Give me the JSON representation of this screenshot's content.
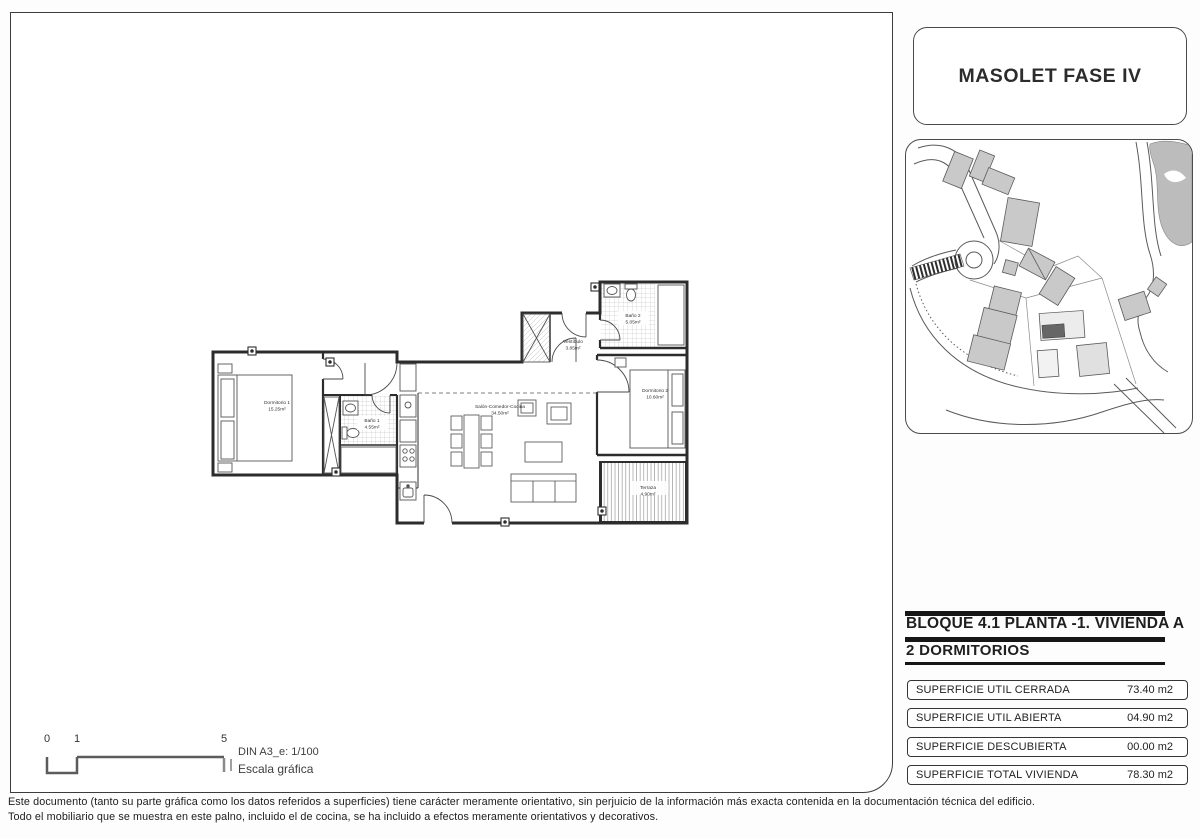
{
  "project": {
    "title": "MASOLET FASE IV"
  },
  "unit": {
    "block_title": "BLOQUE 4.1 PLANTA -1. VIVIENDA A",
    "bedrooms_title": "2 DORMITORIOS"
  },
  "surface_table": {
    "rows": [
      {
        "label": "SUPERFICIE UTIL CERRADA",
        "value": "73.40 m2"
      },
      {
        "label": "SUPERFICIE UTIL ABIERTA",
        "value": "04.90 m2"
      },
      {
        "label": "SUPERFICIE DESCUBIERTA",
        "value": "00.00 m2"
      },
      {
        "label": "SUPERFICIE TOTAL VIVIENDA",
        "value": "78.30 m2"
      }
    ]
  },
  "floor_plan": {
    "rooms": [
      {
        "name": "Dormitorio 1",
        "area": "15.25m²"
      },
      {
        "name": "Baño 1",
        "area": "4.55m²"
      },
      {
        "name": "Salón-Comedor-Cocina",
        "area": "34.50m²"
      },
      {
        "name": "Vestíbulo",
        "area": "3.85m²"
      },
      {
        "name": "Baño 2",
        "area": "5.05m²"
      },
      {
        "name": "Dormitorio 2",
        "area": "10.60m²"
      },
      {
        "name": "Terraza",
        "area": "4.90m²"
      }
    ]
  },
  "scale": {
    "tick0": "0",
    "tick1": "1",
    "tick5": "5",
    "din": "DIN A3_e: 1/100",
    "label": "Escala gráfica"
  },
  "disclaimer": {
    "line1": "Este documento (tanto su parte gráfica como los datos referidos a superficies) tiene carácter meramente orientativo, sin perjuicio de la información más exacta contenida en la documentación  técnica del edificio.",
    "line2": "Todo el mobiliario que se muestra en este palno, incluido el de cocina, se ha incluido a efectos meramente orientativos y decorativos."
  },
  "colors": {
    "line": "#3c3c3c",
    "building_fill": "#c9c9c9",
    "highlight_building": "#666666",
    "tile_hatch": "#b8b8b8"
  }
}
